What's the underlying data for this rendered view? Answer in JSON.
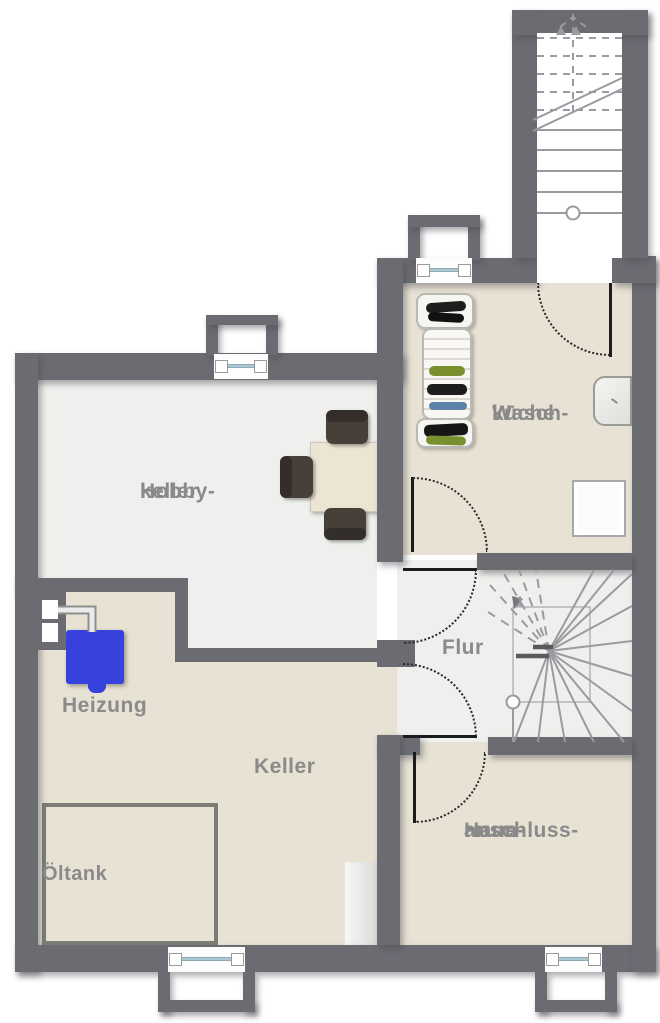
{
  "floorplan": {
    "rooms": {
      "hobbykeller": {
        "label_lines": [
          "Hobby-",
          "keller"
        ]
      },
      "waschkueche": {
        "label_lines": [
          "Wasch-",
          "küche"
        ]
      },
      "heizung": {
        "label_lines": [
          "Heizung"
        ]
      },
      "keller": {
        "label_lines": [
          "Keller"
        ]
      },
      "oeltank": {
        "label_lines": [
          "Öltank"
        ]
      },
      "flur": {
        "label_lines": [
          "Flur"
        ]
      },
      "hausanschlussraum": {
        "label_lines": [
          "Haus-",
          "anschluss-",
          "raum"
        ]
      }
    },
    "stair_step_number": "1",
    "fixtures": [
      "heating-boiler",
      "oil-tank",
      "square-table",
      "chair",
      "chair",
      "chair",
      "laundry-rack",
      "laundry-rack",
      "laundry-rack",
      "wash-basin",
      "washing-machine",
      "freezer-cabinet",
      "exterior-staircase",
      "interior-winder-staircase",
      "window",
      "window",
      "window",
      "window",
      "door",
      "door",
      "door",
      "door",
      "door"
    ],
    "colors": {
      "wall": "#6b6b72",
      "floor_beige": "#e8e2d4",
      "floor_light": "#eff0ed",
      "label_text": "#8a8a8a",
      "heater_blue": "#3742dd",
      "door_leaf": "#1c1c1c",
      "stair_lines": "#9a9aa0",
      "window_glass": "#a9c9d5"
    }
  }
}
